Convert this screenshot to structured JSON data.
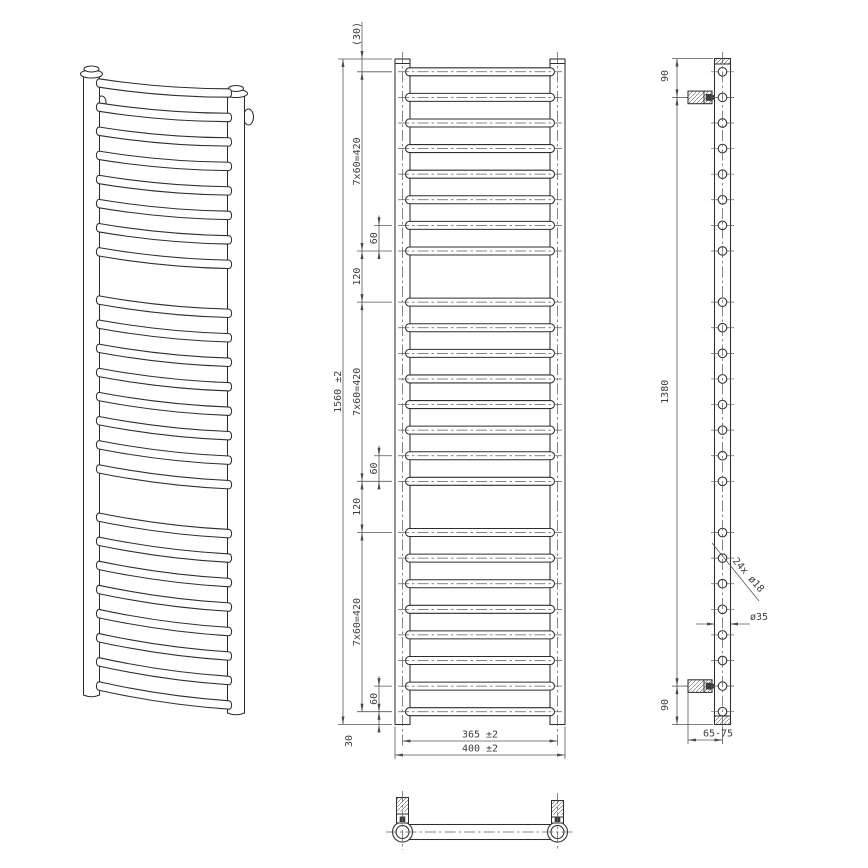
{
  "colors": {
    "background": "#ffffff",
    "outline": "#2d2d2d",
    "dimension_lines": "#565656",
    "text": "#3e3e3e"
  },
  "rungs": {
    "count": 24,
    "groups": [
      8,
      8,
      8
    ],
    "first_offset_mm": 30,
    "pitch_mm": 60,
    "group_gap_mm": 120,
    "total_height_mm": 1560
  },
  "front_view": {
    "top_offset": "(30)",
    "group_pitch": "7x60=420",
    "pitch": "60",
    "group_gap": "120",
    "bottom_offset": "30",
    "overall_height": "1560 ±2",
    "axis_width": "365 ±2",
    "overall_width": "400 ±2"
  },
  "side_view": {
    "top_bracket_offset": "90",
    "bracket_span": "1380",
    "bottom_bracket_offset": "90",
    "bracket_depth": "65-75",
    "rung_holes": "24x ø18",
    "tube_diameter": "ø35"
  }
}
